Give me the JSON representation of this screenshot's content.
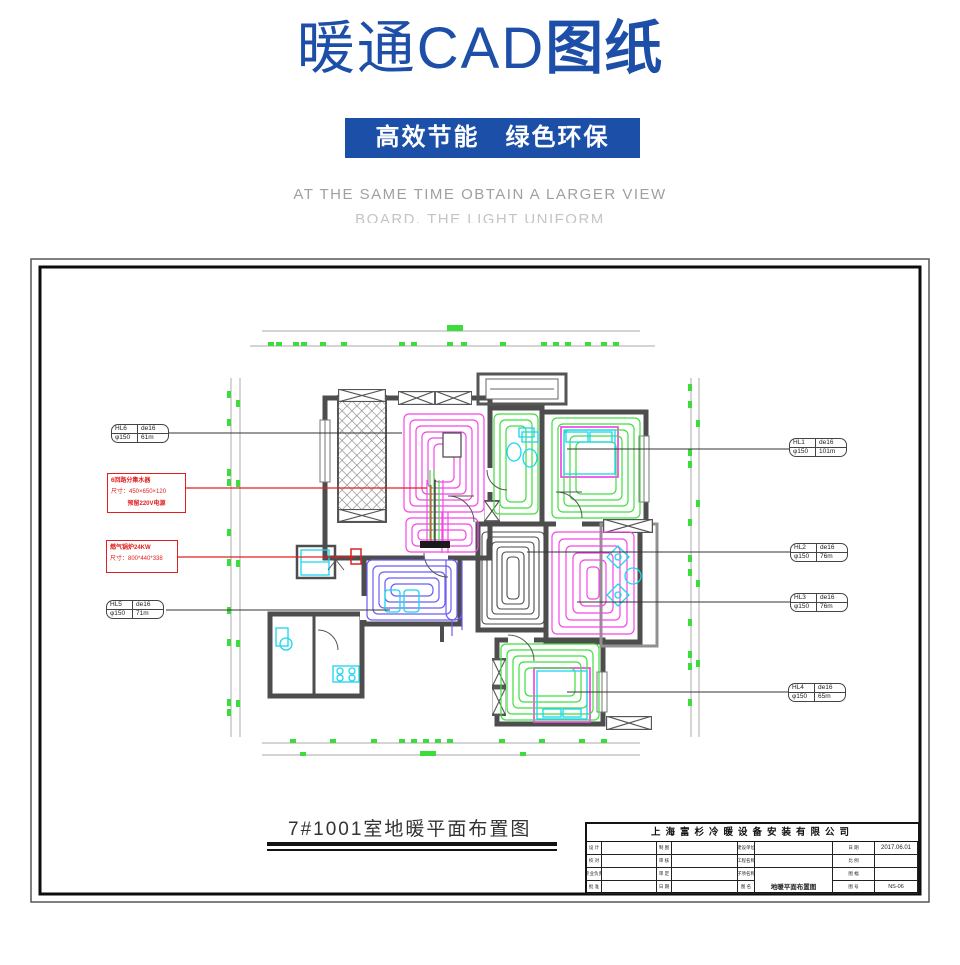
{
  "header": {
    "title_main": "暖通CAD",
    "title_accent": "图纸",
    "banner": "高效节能　绿色环保",
    "subtitle_line1": "AT THE SAME TIME OBTAIN A LARGER VIEW",
    "subtitle_line2": "BOARD, THE LIGHT UNIFORM"
  },
  "drawing": {
    "caption": "7#1001室地暖平面布置图",
    "loop_labels": [
      {
        "id": "HL1",
        "pipe": "de16",
        "diameter": "φ150",
        "length": "101m"
      },
      {
        "id": "HL2",
        "pipe": "de16",
        "diameter": "φ150",
        "length": "76m"
      },
      {
        "id": "HL3",
        "pipe": "de16",
        "diameter": "φ150",
        "length": "76m"
      },
      {
        "id": "HL4",
        "pipe": "de16",
        "diameter": "φ150",
        "length": "65m"
      },
      {
        "id": "HL5",
        "pipe": "de16",
        "diameter": "φ150",
        "length": "71m"
      },
      {
        "id": "HL6",
        "pipe": "de16",
        "diameter": "φ150",
        "length": "61m"
      }
    ],
    "annotation_manifold": {
      "line1": "6回路分集水器",
      "line2": "尺寸：450×650×120",
      "line3": "预留220V电源"
    },
    "annotation_boiler": {
      "line1": "燃气锅炉24KW",
      "line2": "尺寸：800*440*338"
    }
  },
  "titleblock": {
    "company": "上海富杉冷暖设备安装有限公司",
    "date": "2017.06.01",
    "drawing_name": "地暖平面布置图",
    "drawing_no": "NS-06",
    "left_labels": [
      "设 计",
      "制 图",
      "校 对",
      "审 核",
      "专业负责",
      "审 定",
      "批 准",
      "日 期"
    ],
    "mid_labels": [
      "建设单位",
      "工程名称",
      "子项名称",
      "图 名"
    ],
    "right_labels": [
      "日 期",
      "比 例",
      "图 幅",
      "图 号"
    ]
  },
  "colors": {
    "accent_blue": "#1b4fa8",
    "coil_magenta": "#f545e8",
    "coil_green": "#3fe03c",
    "coil_blue": "#6b5cf5",
    "coil_dark": "#4a4a4a",
    "furniture_cyan": "#19d6ee",
    "dimension_green": "#3bdc3b",
    "annotation_red": "#e02020",
    "wall_gray": "#4d4d4d"
  }
}
